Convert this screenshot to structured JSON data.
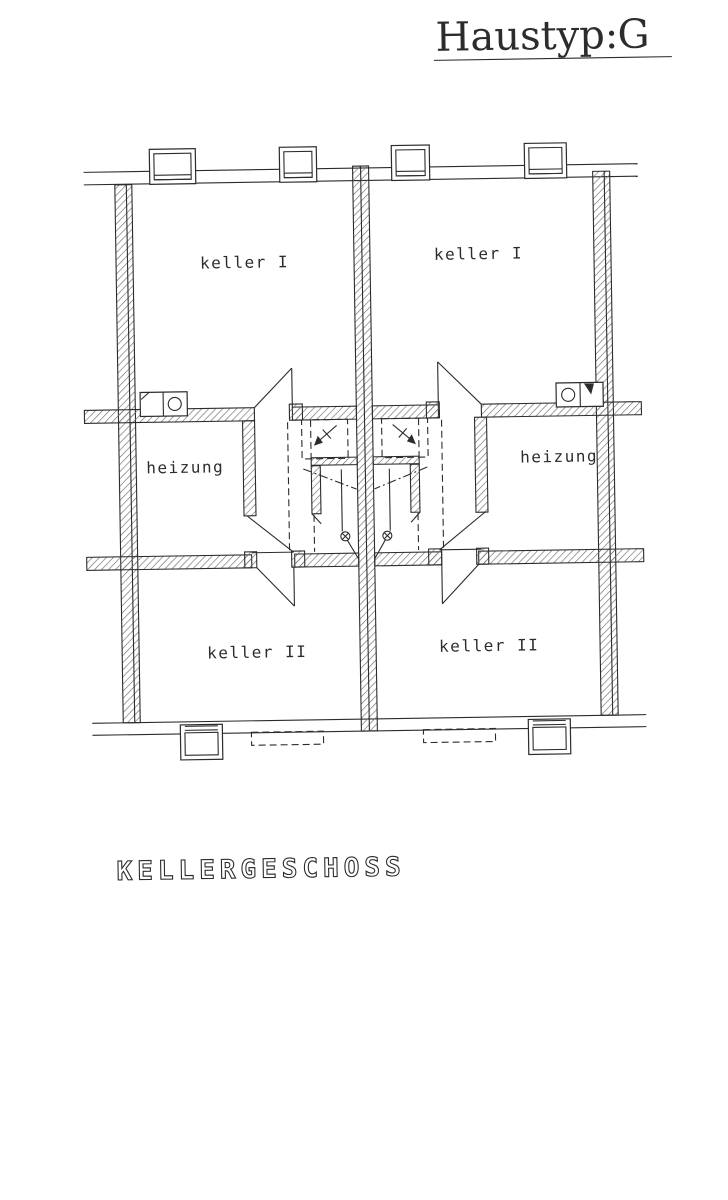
{
  "sheet": {
    "title_label": "Haustyp:",
    "title_value": "G",
    "caption": "KELLERGESCHOSS"
  },
  "rooms": {
    "left_keller1": "keller I",
    "right_keller1": "keller I",
    "left_heizung": "heizung",
    "right_heizung": "heizung",
    "left_keller2": "keller II",
    "right_keller2": "keller II"
  },
  "colors": {
    "ink": "#2c2c2c",
    "paper": "#ffffff"
  }
}
